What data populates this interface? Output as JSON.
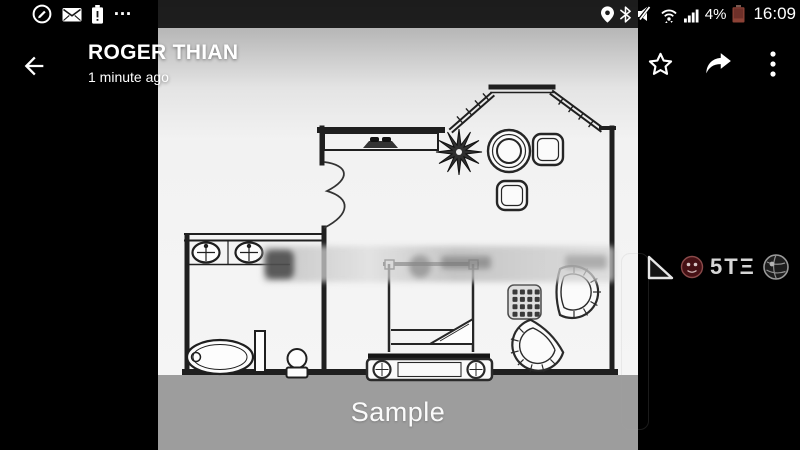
{
  "status_bar": {
    "time": "16:09",
    "battery_percent": "4%",
    "more_indicator": "…",
    "left_icons": [
      "edit-note-icon",
      "email-icon",
      "battery-alert-icon"
    ],
    "right_icons": [
      "location-icon",
      "bluetooth-icon",
      "mute-icon",
      "wifi-icon",
      "signal-strength-icon",
      "battery-icon"
    ],
    "colors": {
      "bar_background": "rgba(0,0,0,0.84)",
      "battery_low": "#8c4236"
    }
  },
  "header": {
    "title": "ROGER THIAN",
    "subtitle": "1 minute ago",
    "actions": [
      "favorite",
      "share",
      "more-options"
    ]
  },
  "photo": {
    "content": "floor-plan",
    "sample_watermark": "Sample",
    "band_color": "#9d9d9d"
  },
  "overlay_watermark": {
    "text": "5TΞ",
    "icons": [
      "triangle-icon",
      "red-badge-icon",
      "sphere-icon"
    ]
  }
}
